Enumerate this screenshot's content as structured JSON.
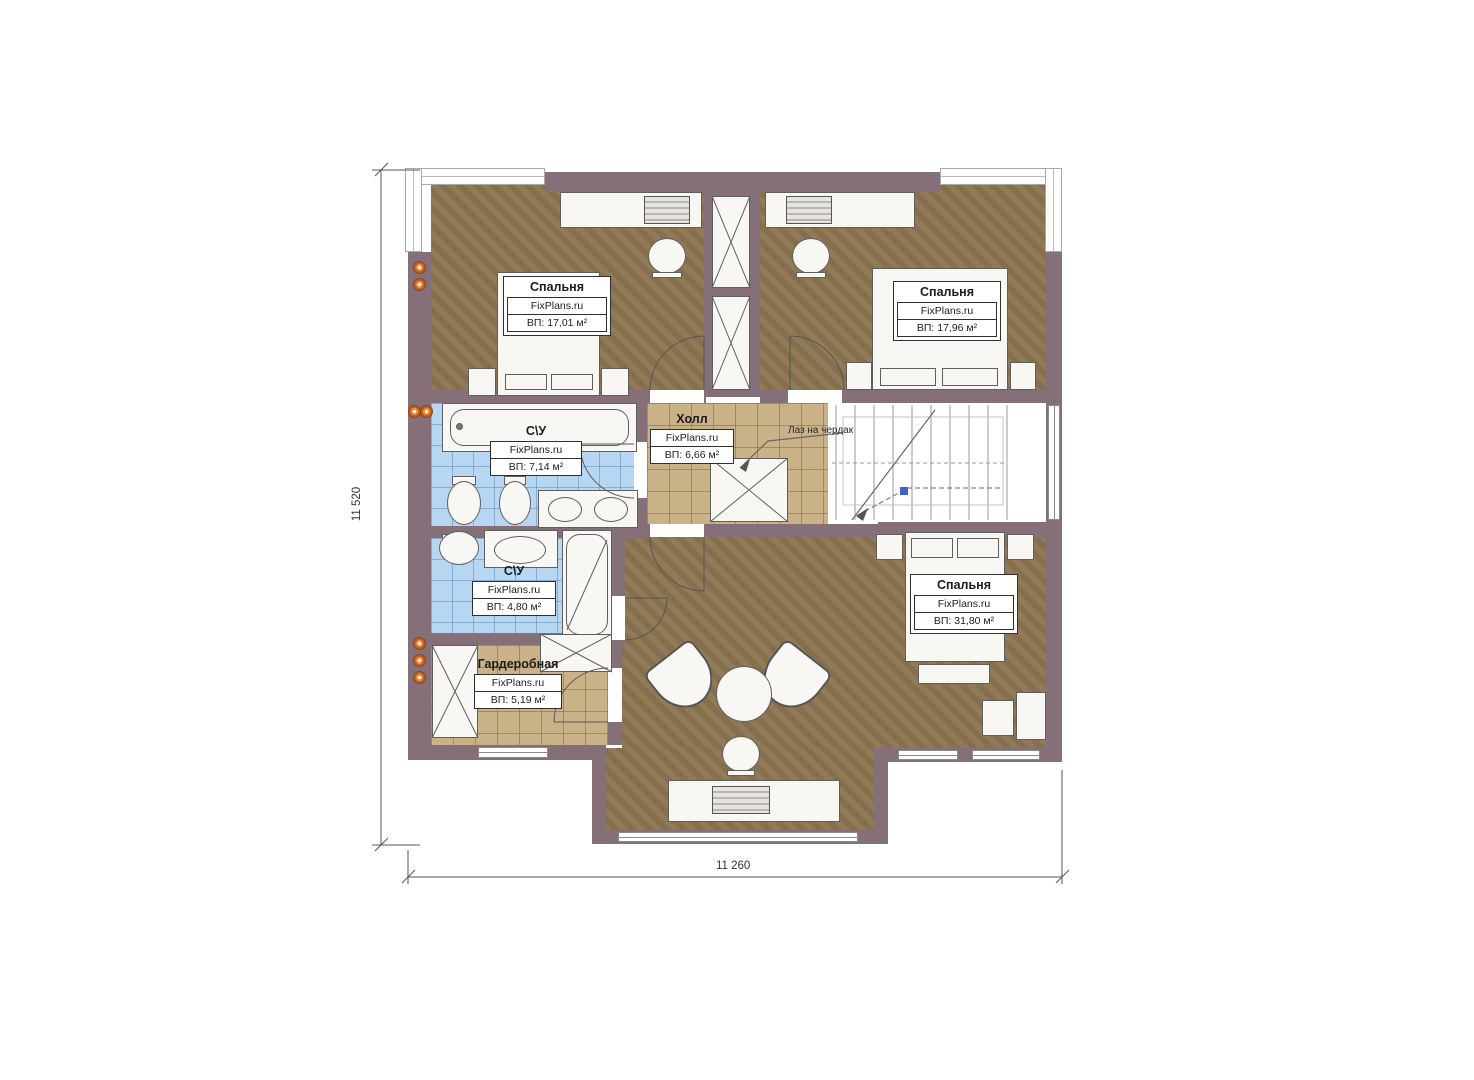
{
  "plan": {
    "brand": "FixPlans.ru",
    "rooms": [
      {
        "name": "Спальня",
        "area": "ВП: 17,01 м²"
      },
      {
        "name": "Спальня",
        "area": "ВП: 17,96 м²"
      },
      {
        "name": "С\\У",
        "area": "ВП: 7,14 м²"
      },
      {
        "name": "Холл",
        "area": "ВП: 6,66 м²"
      },
      {
        "name": "С\\У",
        "area": "ВП: 4,80 м²"
      },
      {
        "name": "Гардеробная",
        "area": "ВП: 5,19 м²"
      },
      {
        "name": "Спальня",
        "area": "ВП: 31,80 м²"
      }
    ],
    "annotations": {
      "attic_hatch": "Лаз на чердак"
    },
    "dimensions": {
      "vertical": "11 520",
      "horizontal": "11 260"
    },
    "colors": {
      "wall": "#85707a",
      "floor_brown": "#8c7551",
      "tile_tan": "#c9b288",
      "tile_blue": "#b6d6f2",
      "marker_orange": "#f49140"
    }
  }
}
